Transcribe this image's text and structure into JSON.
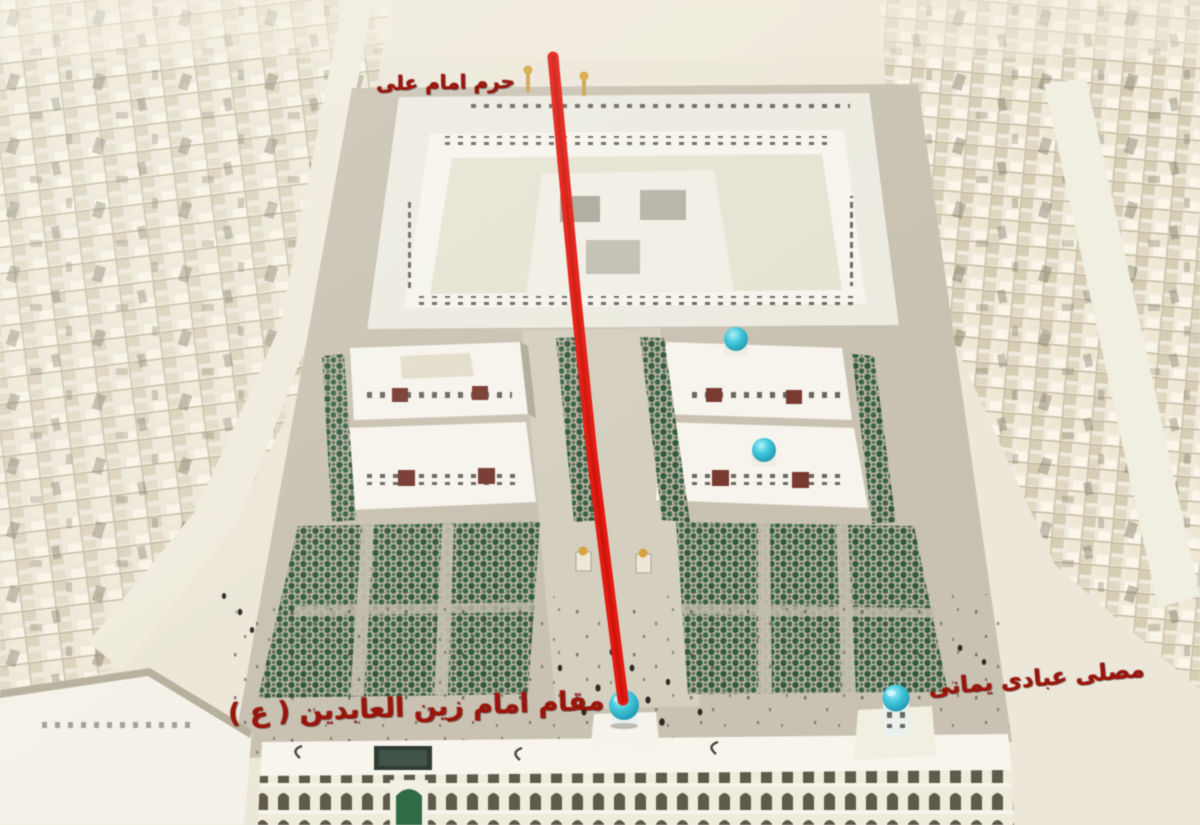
{
  "annotations": {
    "shrine_label": "حرم امام علی",
    "maqam_label": "مقام امام زین العابدین ( ع )",
    "musalla_label": "مصلی عبادی یمانی"
  },
  "route_line": {
    "color": "#e8190f",
    "points": "553,57 575,290 592,455 623,700"
  },
  "colors": {
    "city": "#ece7d8",
    "city_shadow": "#cfc6ae",
    "plaza": "#c9c2b2",
    "esplanade": "#d5cfc0",
    "building": "#f6f4ec",
    "building_shade": "#b2ac9c",
    "trees": "#2d5a3d",
    "dome_cyan": "#3fc9dd",
    "dome_green": "#2f6b45",
    "label_red": "#a01208"
  }
}
